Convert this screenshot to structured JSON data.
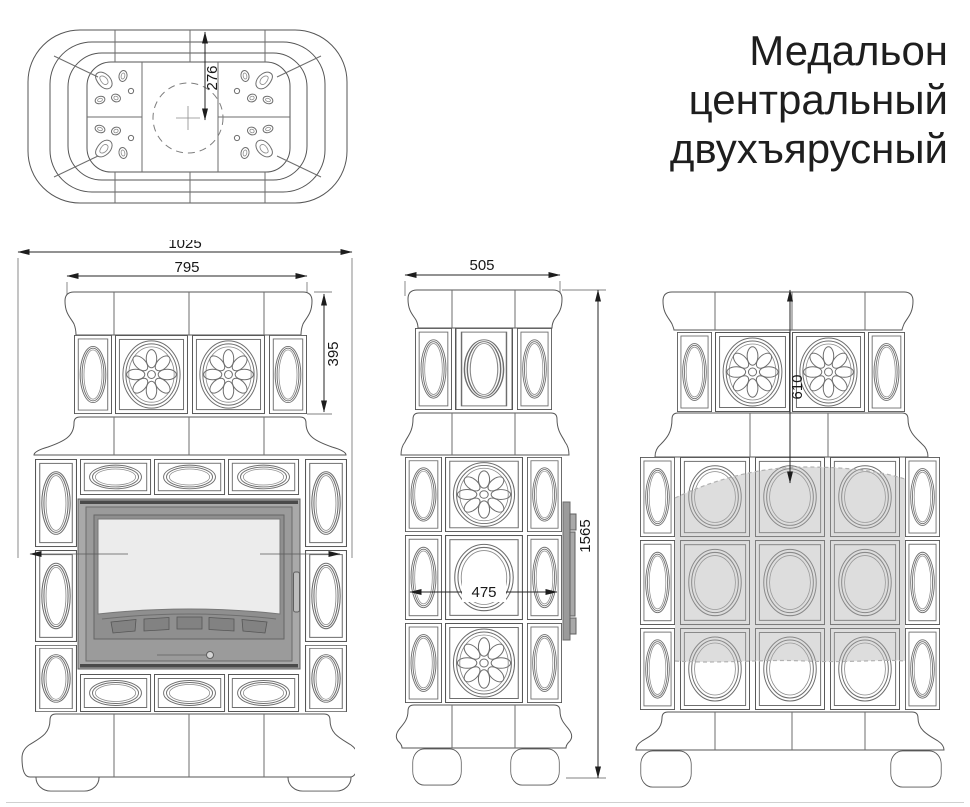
{
  "title": {
    "lines": [
      "Медальон",
      "центральный",
      "двухъярусный"
    ]
  },
  "dimensions": {
    "top_view_center_offset": "276",
    "front_overall_width": "1025",
    "front_upper_tier_width": "795",
    "front_upper_tier_height": "395",
    "side_top_width": "505",
    "side_total_height": "1565",
    "side_tile_field_width": "475",
    "back_upper_zone_height": "610"
  },
  "colors": {
    "line": "#565656",
    "dimension": "#1d1d1d",
    "door_frame": "#a9a9a9",
    "door_glass": "#ececec",
    "shaded_zone": "#aeaeae"
  }
}
